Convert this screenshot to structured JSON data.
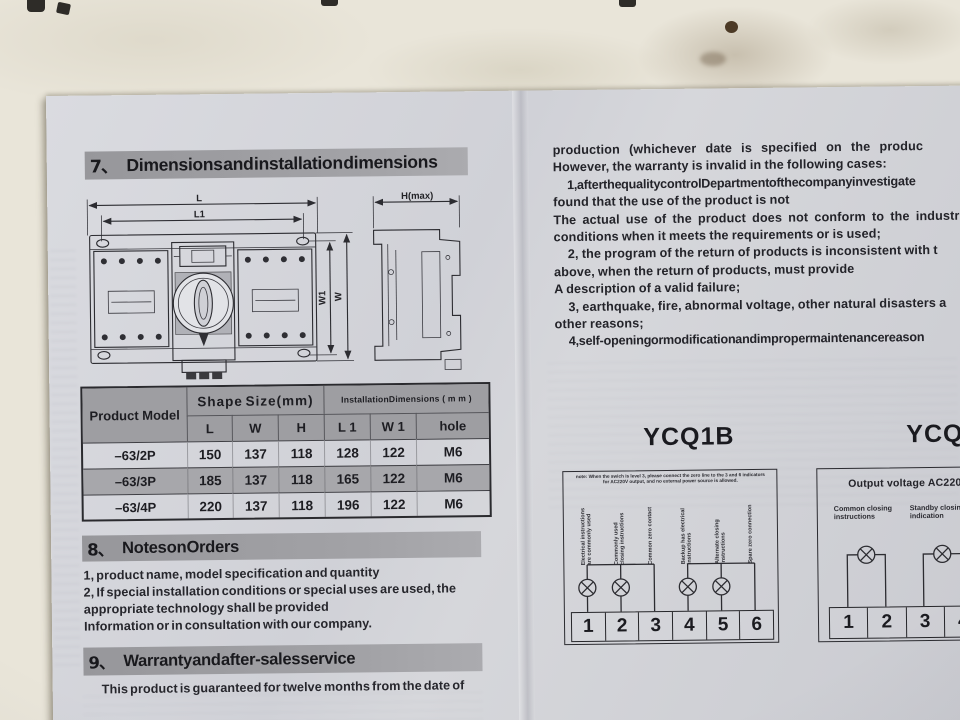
{
  "left_page": {
    "section7": {
      "number": "7、",
      "title": "Dimensions and installation dimensions"
    },
    "drawing": {
      "dims": {
        "l": "L",
        "l1": "L1",
        "w1": "W1",
        "w": "W",
        "h": "H(max)"
      }
    },
    "table": {
      "col_product": "Product Model",
      "group_shape": "Shape Size(mm)",
      "group_install": "InstallationDimensions ( m m )",
      "columns": [
        "L",
        "W",
        "H",
        "L 1",
        "W 1",
        "hole"
      ],
      "rows": [
        {
          "model": "–63/2P",
          "l": "150",
          "w": "137",
          "h": "118",
          "l1": "128",
          "w1": "122",
          "hole": "M6"
        },
        {
          "model": "–63/3P",
          "l": "185",
          "w": "137",
          "h": "118",
          "l1": "165",
          "w1": "122",
          "hole": "M6"
        },
        {
          "model": "–63/4P",
          "l": "220",
          "w": "137",
          "h": "118",
          "l1": "196",
          "w1": "122",
          "hole": "M6"
        }
      ]
    },
    "section8": {
      "number": "8、",
      "title": "Notes on Orders",
      "lines": [
        "1, product name, model specification and quantity",
        "2, If special installation conditions or special uses are used, the",
        "appropriate technology shall be provided",
        "Information or in consultation with our company."
      ]
    },
    "section9": {
      "number": "9、",
      "title": "Warranty and after-sales service",
      "lines": [
        "This product is guaranteed for twelve months from the date of"
      ]
    }
  },
  "right_page": {
    "warranty_lines": [
      "production (whichever date is specified on the produc",
      "However, the warranty is invalid in the following cases:",
      "1, after the quality control Department of the company investigate",
      "found that the use of the product is not",
      "The actual use of the product does not conform to the industr",
      "conditions when it meets the requirements or is used;",
      "2, the program of the return of products is inconsistent with t",
      "above, when the return of products, must provide",
      "A description of a valid failure;",
      "3, earthquake, fire, abnormal voltage, other natural disasters a",
      "other reasons;",
      "4, self-opening or modification and improper maintenance reason"
    ],
    "ycq1b": {
      "title": "YCQ1B",
      "note_line1": "note: When the swich is level 3, please connect the zero line to the 3 and 6 indicators",
      "note_line2": "for AC220V output, and no external power source is allowed.",
      "terminal_labels": [
        "Electrical instructions are commonly used",
        "Commonly used closing instructions",
        "Common zero contact",
        "Backup has electrical instructions",
        "Alternate closing instructions",
        "Spare zero connection"
      ],
      "terminals": [
        "1",
        "2",
        "3",
        "4",
        "5",
        "6"
      ]
    },
    "ycq3b": {
      "title": "YCQ3B",
      "output_voltage": "Output voltage AC220V",
      "labels": [
        "Common closing instructions",
        "Standby closing indication"
      ],
      "terminals": [
        "1",
        "2",
        "3",
        "4"
      ]
    }
  },
  "colors": {
    "page": "#d0d1d7",
    "heading_bar": "#9b9b9f",
    "table_header": "#9e9ea2",
    "ink": "#1e1e22"
  }
}
